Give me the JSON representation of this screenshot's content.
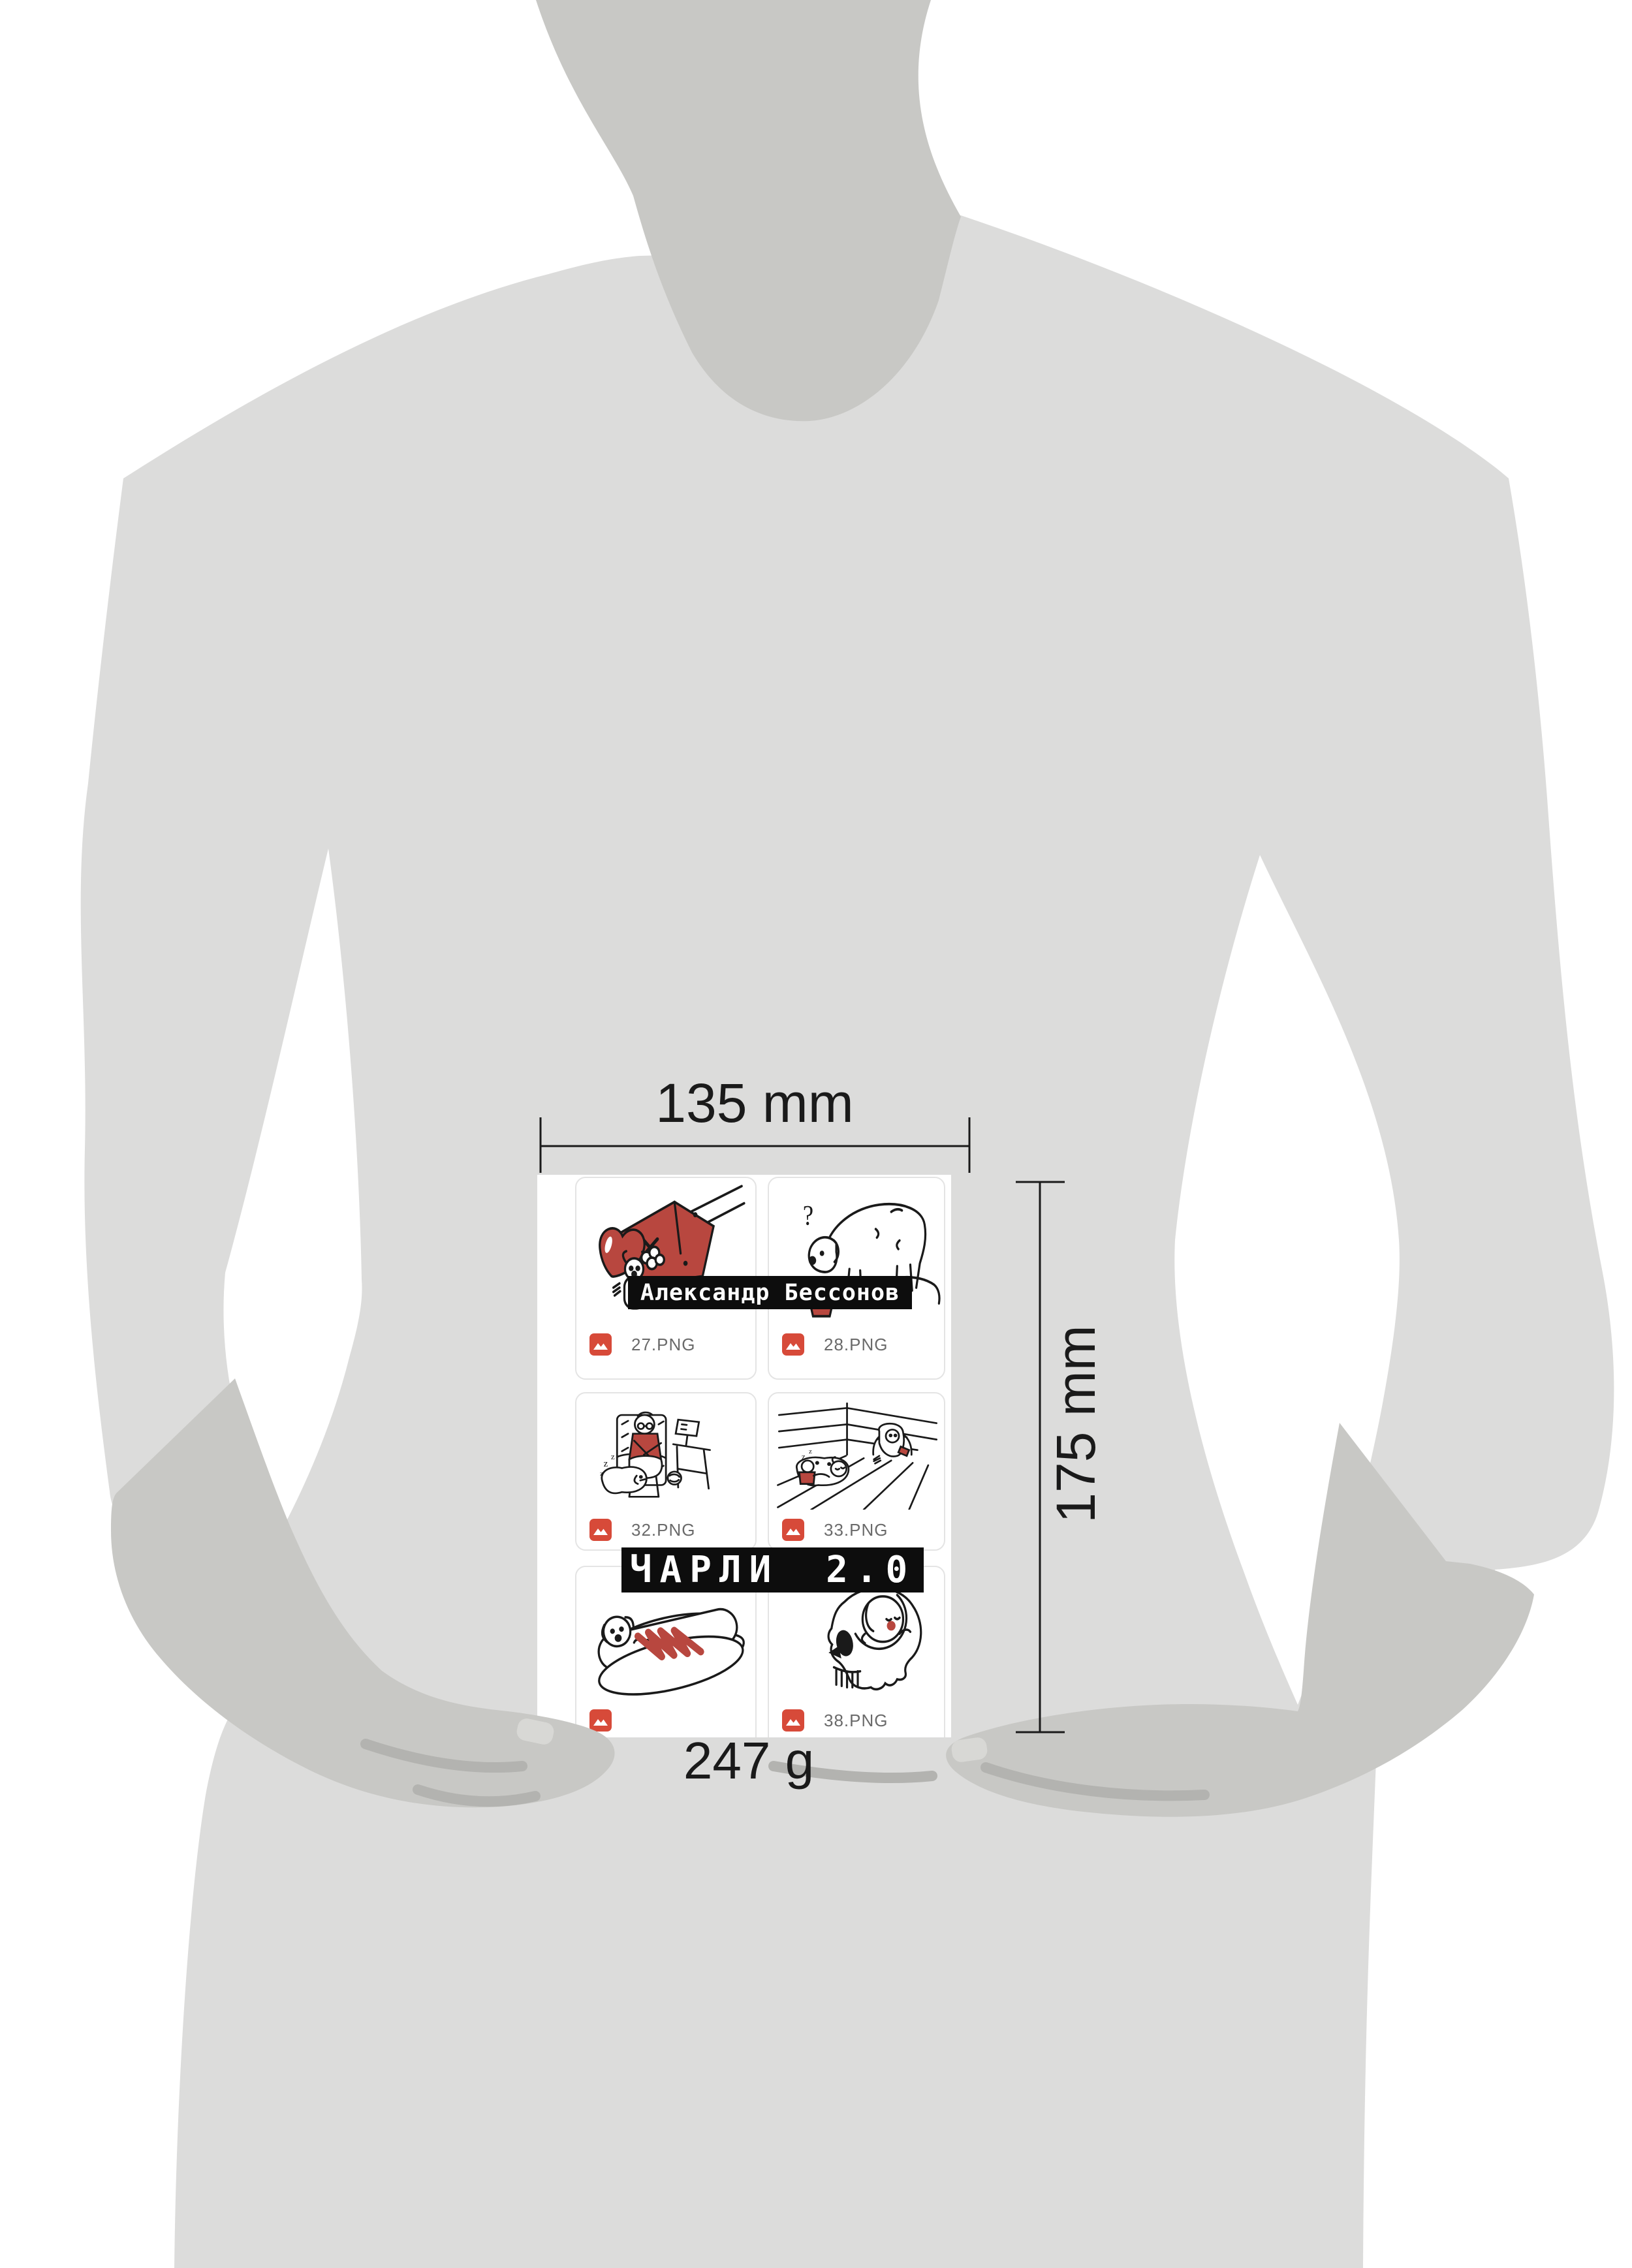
{
  "annotations": {
    "width_label": "135 mm",
    "height_label": "175 mm",
    "weight_label": "247 g"
  },
  "book": {
    "author_banner": "Александр Бессонов",
    "title_banner": "ЧАРЛИ 2.0",
    "cards": [
      {
        "filename": "27.PNG",
        "panel": "doghouse-heart-puppy"
      },
      {
        "filename": "28.PNG",
        "panel": "dog-sniffing-bowl"
      },
      {
        "filename": "32.PNG",
        "panel": "granny-knitting-sleeping-dog"
      },
      {
        "filename": "33.PNG",
        "panel": "kid-and-dog-room-corner"
      },
      {
        "filename": "",
        "panel": "dachshund-hotdog"
      },
      {
        "filename": "38.PNG",
        "panel": "skull-sleeping-puppy"
      }
    ]
  },
  "colors": {
    "background": "#ffffff",
    "silhouette": "#dcdcdb",
    "silhouette_dark": "#c8c8c5",
    "crease": "#b3b3b0",
    "accent_red": "#b8473f",
    "icon_red": "#d74a39",
    "banner_bg": "#0d0d0d",
    "filename_text": "#6a6a6a",
    "dimension_text": "#1a1a1a"
  }
}
